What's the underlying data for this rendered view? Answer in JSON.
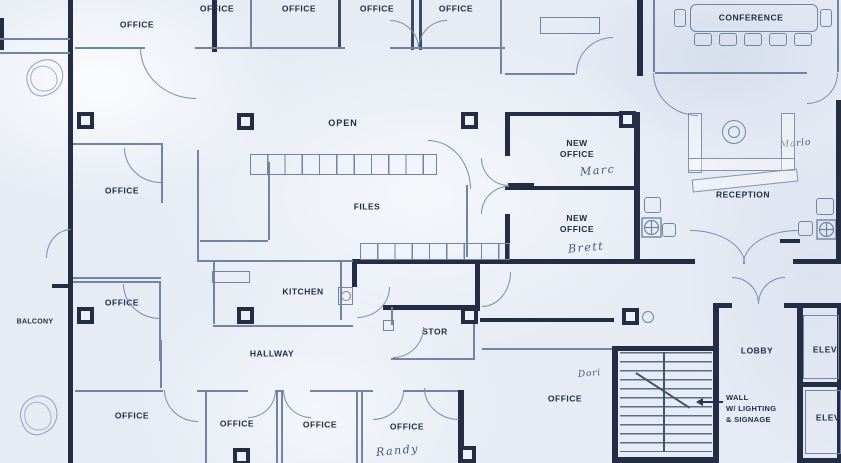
{
  "drawing": {
    "type": "scanned office floor plan blueprint",
    "colors": {
      "paper": "#e6ebf4",
      "line": "#7284a3",
      "wall": "#242d44",
      "ink": "#232c46",
      "pencil": "#46547a"
    },
    "rooms": {
      "top_offices": [
        {
          "label": "OFFICE"
        },
        {
          "label": "OFFICE"
        },
        {
          "label": "OFFICE"
        },
        {
          "label": "OFFICE"
        },
        {
          "label": "OFFICE"
        }
      ],
      "conference": {
        "label": "CONFERENCE"
      },
      "left_offices": [
        {
          "label": "OFFICE"
        },
        {
          "label": "OFFICE"
        }
      ],
      "balcony": {
        "label": "BALCONY"
      },
      "open_area": {
        "label": "OPEN"
      },
      "files": {
        "label": "FILES"
      },
      "kitchen": {
        "label": "KITCHEN"
      },
      "hallway": {
        "label": "HALLWAY"
      },
      "storage": {
        "label": "STOR"
      },
      "new_offices": [
        {
          "label": "NEW\nOFFICE",
          "note": "Marc"
        },
        {
          "label": "NEW\nOFFICE",
          "note": "Brett"
        }
      ],
      "reception": {
        "label": "RECEPTION",
        "note": "Marlo"
      },
      "lobby": {
        "label": "LOBBY"
      },
      "elevators": [
        {
          "label": "ELEV."
        },
        {
          "label": "ELEV"
        }
      ],
      "bottom_offices": [
        {
          "label": "OFFICE"
        },
        {
          "label": "OFFICE"
        },
        {
          "label": "OFFICE"
        },
        {
          "label": "OFFICE",
          "note": "Randy"
        }
      ],
      "corner_office": {
        "label": "OFFICE",
        "note": "Dori"
      }
    },
    "annotations": {
      "wall_callout": {
        "text": "WALL\nW/ LIGHTING\n& SIGNAGE"
      }
    },
    "symbols": [
      "conference-table",
      "reception-desk",
      "staircase",
      "kitchen-sink",
      "file-cabinet-run",
      "structural-column",
      "door-swing-arc",
      "handwritten-scribble"
    ]
  }
}
